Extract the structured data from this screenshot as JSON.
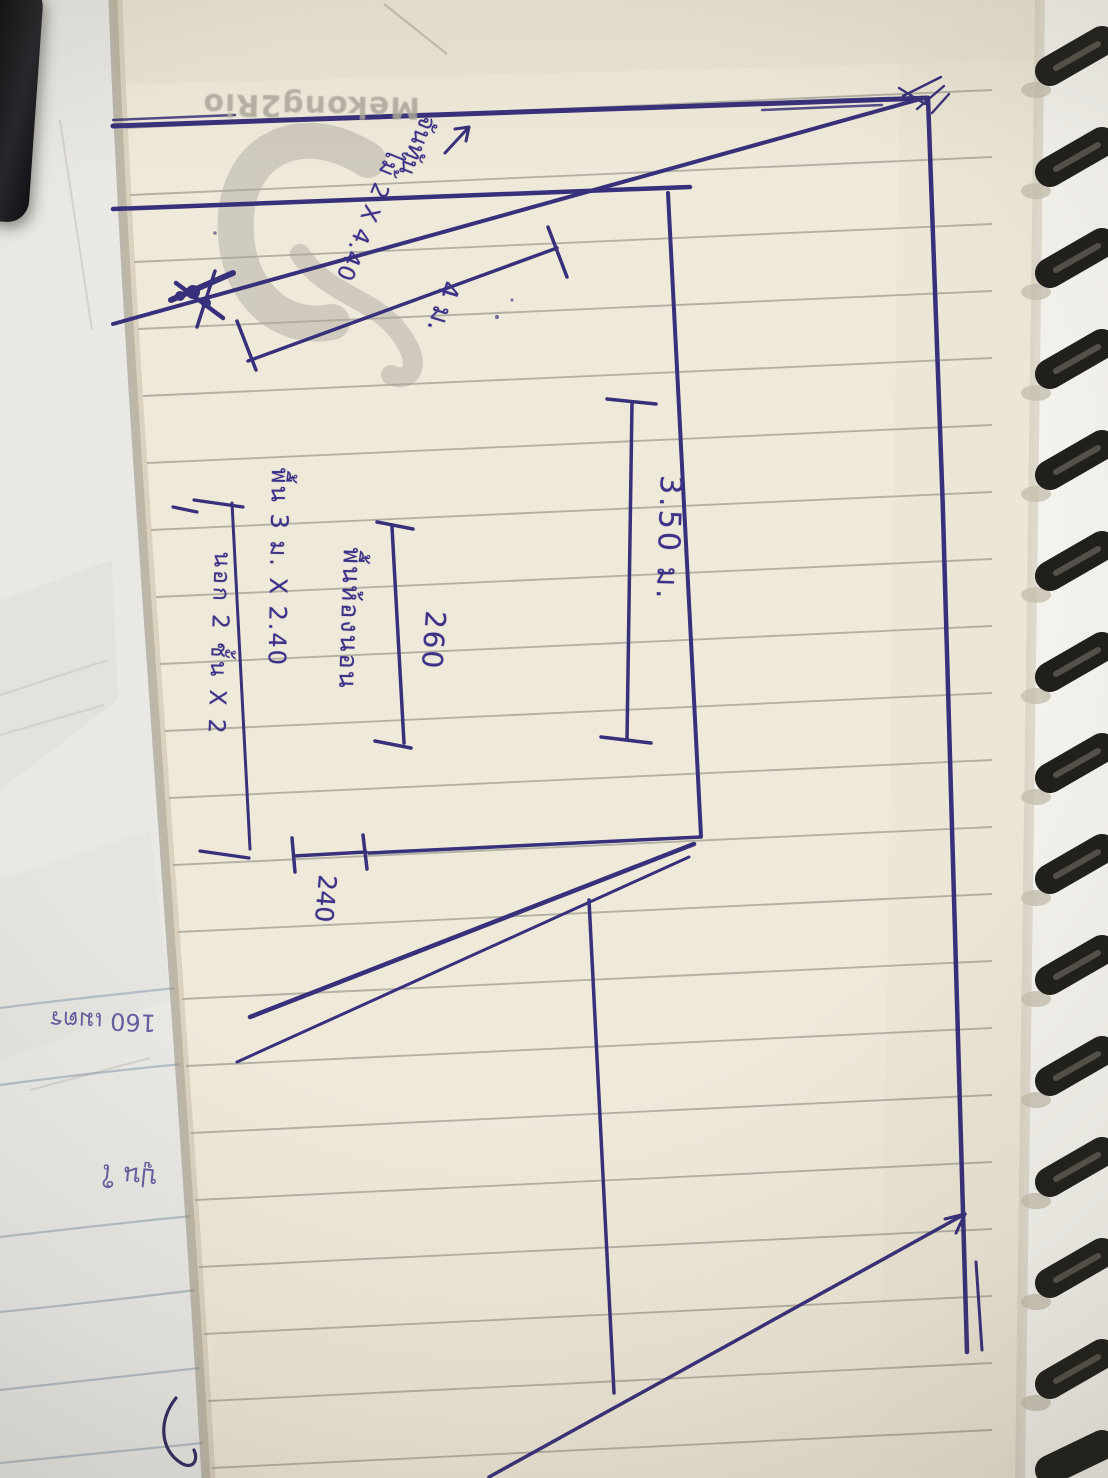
{
  "colors": {
    "pen_ink": "#3b3287",
    "paper_cream": "#efe9da",
    "under_page": "#e9e8e5",
    "ruled_line": "#a3a295",
    "spiral_coil": "#201f1c"
  },
  "watermark": {
    "brand_text": "Mekong2Rio"
  },
  "sketch_labels": {
    "span_length": "3.50 ม.",
    "mid_width": "260",
    "room_label": "พื้นห้องนอน",
    "floor_note_1": "พื้น 3 ม. X 2.40",
    "floor_note_2": "นอก 2 ชั้น X 2",
    "height": "240",
    "rafter_length": "4 ม.",
    "rafter_member": "ไม้ 2 X 4.40",
    "rafter_name": "จันทัน"
  },
  "underpage_notes": {
    "note_1": "160 เมตร",
    "note_2": "ปูน ใ"
  }
}
